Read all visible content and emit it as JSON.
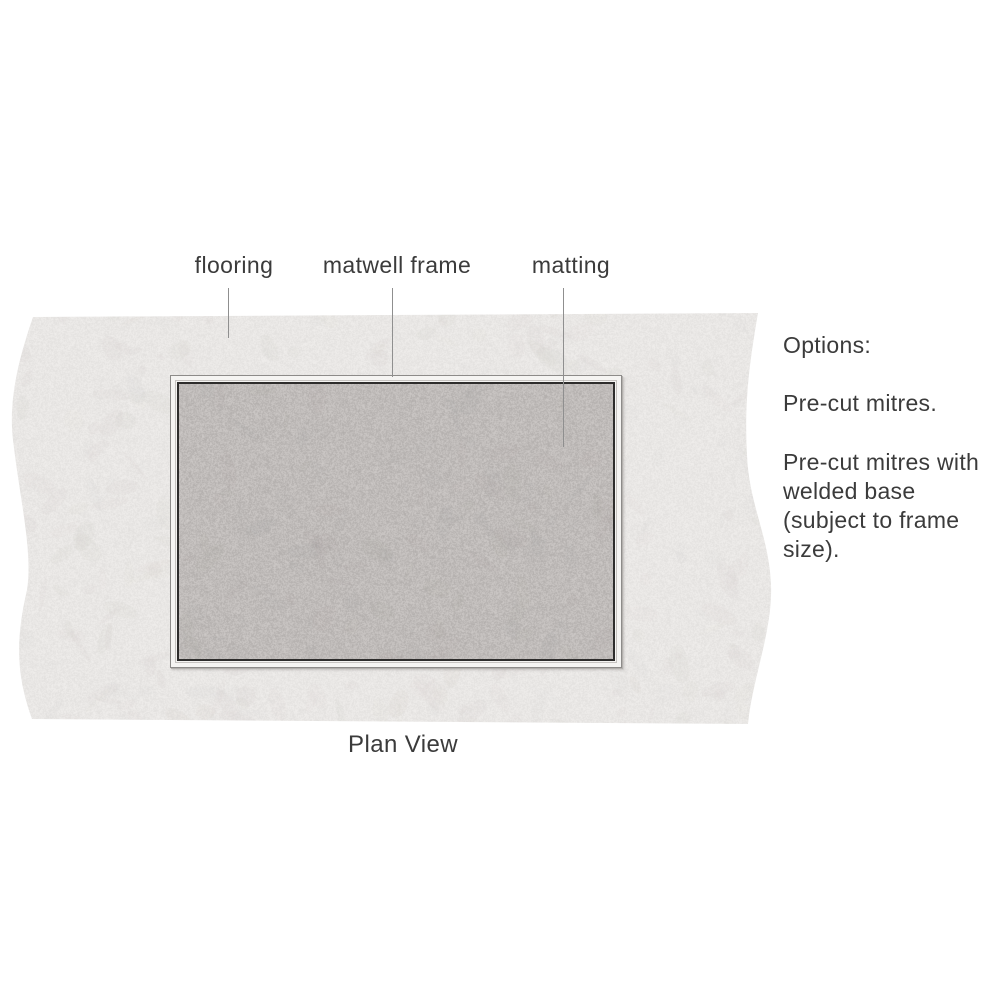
{
  "diagram": {
    "caption": "Plan View",
    "labels": {
      "flooring": "flooring",
      "matwell_frame": "matwell frame",
      "matting": "matting"
    },
    "options": {
      "heading": "Options:",
      "item1": "Pre-cut mitres.",
      "item2_lines": [
        "Pre-cut mitres with",
        "welded base",
        "(subject to frame",
        "size)."
      ]
    },
    "colors": {
      "flooring_base": "#eae8e6",
      "flooring_mottle": "#cfc9c6",
      "matting_base": "#c1bdbb",
      "matting_grain": "#a5a19f",
      "frame_face": "#f5f4f2",
      "frame_outer_edge": "#8d8b89",
      "frame_inner_line": "#2e2d2c",
      "text": "#3b3b3b",
      "leader_line": "#8f8f8f"
    }
  }
}
